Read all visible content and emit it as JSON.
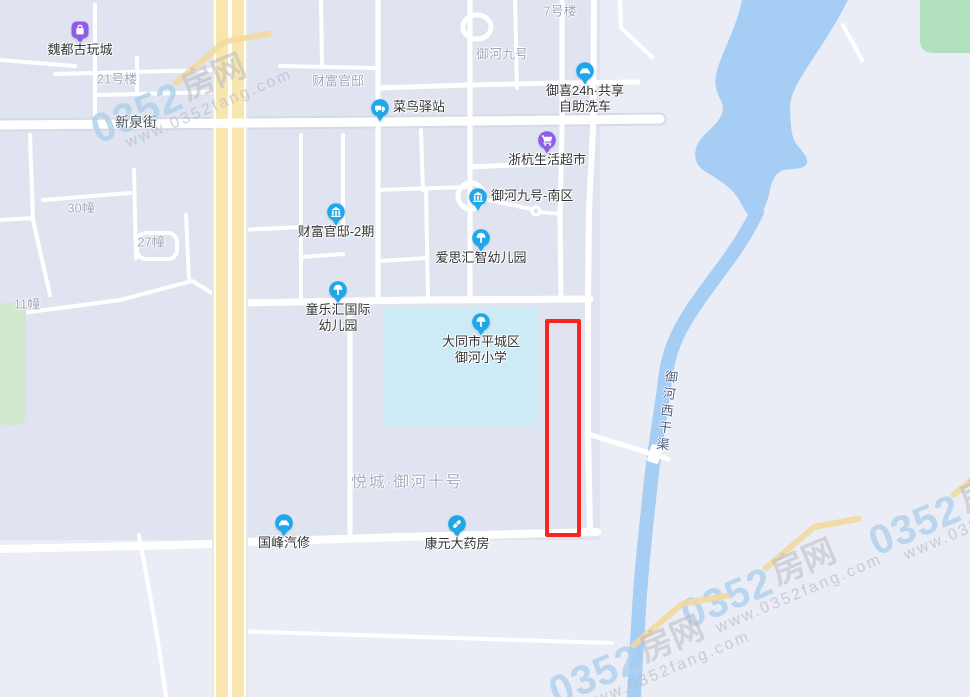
{
  "map": {
    "colors": {
      "poi_blue": "#1ea7e9",
      "poi_purple": "#8f5ce6",
      "highlight_red": "#f5261f",
      "river_blue": "#a6cdf3",
      "school_cyan": "#cdeaf7",
      "highway_yellow": "#f8e6ae",
      "green_dark": "#b2e1bf",
      "green_light": "#d0e8d0",
      "block_gray": "#dfe4f0"
    },
    "pois": [
      {
        "name": "魏都古玩城",
        "icon": "bag",
        "variant": "purple",
        "shape": "squircle",
        "x": 80,
        "y": 30,
        "label_side": "below"
      },
      {
        "name": "菜鸟驿站",
        "icon": "truck",
        "variant": "blue",
        "x": 380,
        "y": 108,
        "label_side": "right"
      },
      {
        "name": "御喜24h·共享自助洗车",
        "lines": [
          "御喜24h·共享",
          "自助洗车"
        ],
        "icon": "car",
        "variant": "blue",
        "x": 585,
        "y": 71,
        "label_side": "below"
      },
      {
        "name": "浙杭生活超市",
        "icon": "cart",
        "variant": "purple",
        "x": 547,
        "y": 140,
        "label_side": "below"
      },
      {
        "name": "御河九号-南区",
        "icon": "bank",
        "variant": "blue",
        "x": 478,
        "y": 197,
        "label_side": "right"
      },
      {
        "name": "财富官邸-2期",
        "icon": "bank",
        "variant": "blue",
        "x": 336,
        "y": 212,
        "label_side": "below"
      },
      {
        "name": "爱思汇智幼儿园",
        "icon": "tree",
        "variant": "blue",
        "x": 481,
        "y": 238,
        "label_side": "below"
      },
      {
        "name": "童乐汇国际幼儿园",
        "lines": [
          "童乐汇国际",
          "幼儿园"
        ],
        "icon": "tree",
        "variant": "blue",
        "x": 338,
        "y": 290,
        "label_side": "below"
      },
      {
        "name": "大同市平城区御河小学",
        "lines": [
          "大同市平城区",
          "御河小学"
        ],
        "icon": "tree",
        "variant": "blue",
        "x": 481,
        "y": 322,
        "label_side": "below"
      },
      {
        "name": "国峰汽修",
        "icon": "car",
        "variant": "blue",
        "x": 284,
        "y": 523,
        "label_side": "below"
      },
      {
        "name": "康元大药房",
        "icon": "pill",
        "variant": "blue",
        "x": 457,
        "y": 524,
        "label_side": "below"
      }
    ],
    "area_labels": [
      {
        "text": "21号楼",
        "x": 117,
        "y": 78
      },
      {
        "text": "7号楼",
        "x": 560,
        "y": 10
      },
      {
        "text": "财富官邸",
        "x": 338,
        "y": 80
      },
      {
        "text": "御河九号",
        "x": 502,
        "y": 53
      },
      {
        "text": "30幢",
        "x": 81,
        "y": 207
      },
      {
        "text": "27幢",
        "x": 151,
        "y": 241
      },
      {
        "text": "11幢",
        "x": 27,
        "y": 303
      },
      {
        "text": "悦城·御河十号",
        "x": 407,
        "y": 480,
        "large": true
      }
    ],
    "road_labels": [
      {
        "text": "新泉街",
        "x": 136,
        "y": 122
      }
    ],
    "water_labels": [
      {
        "text": "御河西干渠",
        "x": 666,
        "y": 412
      }
    ],
    "watermarks": {
      "text_num": "0352",
      "text_cn": "房网",
      "url": "www.0352fang.com",
      "positions": [
        {
          "x": 210,
          "y": 100
        },
        {
          "x": 800,
          "y": 585
        },
        {
          "x": 988,
          "y": 512
        },
        {
          "x": 668,
          "y": 662
        }
      ]
    },
    "highlight": {
      "x": 545,
      "y": 319,
      "width": 28,
      "height": 210
    }
  }
}
